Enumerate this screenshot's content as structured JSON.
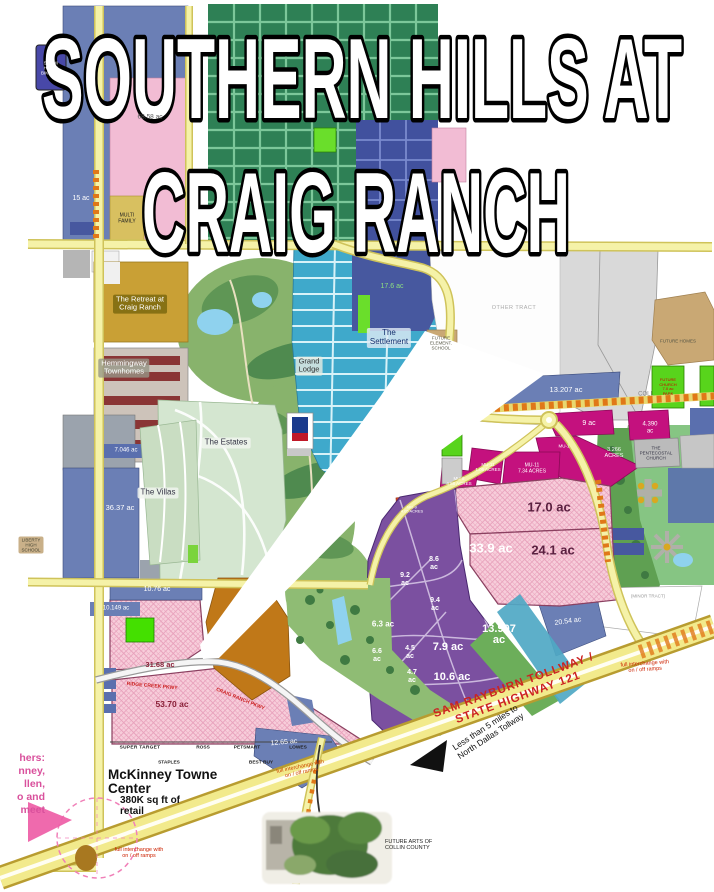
{
  "title": {
    "line1": "SOUTHERN HILLS AT",
    "line2": "CRAIG RANCH"
  },
  "badge": {
    "hike_bike": "50+ MI\nHIKE &\nBIKE TRL"
  },
  "areas": {
    "retreat": "The Retreat at\nCraig Ranch",
    "hemmingway": "Hemmingway\nTownhomes",
    "estates": "The Estates",
    "villas": "The Villas",
    "settlement": "The\nSettlement",
    "grand_lodge": "Grand\nLodge",
    "multi_family": "MULTI\nFAMILY",
    "other_tract": "OTHER TRACT",
    "future_elementary": "FUTURE\nELEMENT.\nSCHOOL",
    "future_homes": "FUTURE HOMES",
    "liberty_high": "LIBERTY\nHIGH\nSCHOOL",
    "pentecostal": "THE\nPENTECOSTAL\nCHURCH",
    "temp_church": "FUTURE\nCHURCH\n7.0 ac\nPARK",
    "coll": "COLL",
    "minor_tract": "(MINOR TRACT)",
    "future_arts": "FUTURE ARTS OF\nCOLLIN COUNTY",
    "mckinney_center": "McKinney Towne\nCenter",
    "mckinney_retail": "380K sq ft of\nretail"
  },
  "acreage": {
    "k68": "68.58 ac",
    "k15": "15 ac",
    "k17_6": "17.6 ac",
    "k13_207": "13.207 ac",
    "k9": "9 ac",
    "k4_390": "4.390\nac",
    "k3_266": "3.266\nACRES",
    "k17_0": "17.0 ac",
    "k24_1": "24.1 ac",
    "k33_9": "33.9 ac",
    "k8_6": "8.6\nac",
    "k9_2": "9.2\nac",
    "k9_4": "9.4\nac",
    "k6_3": "6.3 ac",
    "k6_6": "6.6\nac",
    "k4_5": "4.5\nac",
    "k4_7": "4.7\nac",
    "k7_9": "7.9 ac",
    "k10_6": "10.6 ac",
    "k13_907": "13.907\nac",
    "k20_54": "20.54 ac",
    "k36_37": "36.37 ac",
    "k7_046": "7.046 ac",
    "k10_76": "10.76 ac",
    "k10_149": "10.149 ac",
    "k31_68": "31.68 ac",
    "k53_70": "53.70 ac",
    "k12_65": "12.65 ac"
  },
  "mu": {
    "mu1": "MU-1",
    "mu11_106": "MU-11\n1.06 ACRES",
    "mu11_734": "MU-11\n7.34 ACRES",
    "mu8": "MU-8\n4.88 ACRES",
    "mu9": "MU-9\n4.05 ACRES"
  },
  "roads": {
    "sam_rayburn": "SAM RAYBURN TOLLWAY  /  STATE HIGHWAY 121",
    "ridge_creek": "RIDGE CREEK PKWY",
    "craig_ranch": "CRAIG RANCH PKWY"
  },
  "notes": {
    "less_than": "Less than 5  miles to\nNorth Dallas Tollway",
    "interchange": "full interchange with\non / off ramps",
    "corner": "hers:\nnney,\nllen,\no and\nmeet"
  },
  "stores": {
    "super_target": "SUPER TARGET",
    "ross": "ROSS",
    "petsmart": "PETSMART",
    "lowes": "LOWES",
    "staples": "STAPLES",
    "best_buy": "BEST BUY"
  },
  "colors": {
    "highway_yellow": "#f2ea8c",
    "parcel_pink": "#f7cdda",
    "mixed_use_magenta": "#c4117e",
    "office_purple": "#7b50a0",
    "residential_blue": "#6b7fb5",
    "highway_text_red": "#cc2222"
  }
}
